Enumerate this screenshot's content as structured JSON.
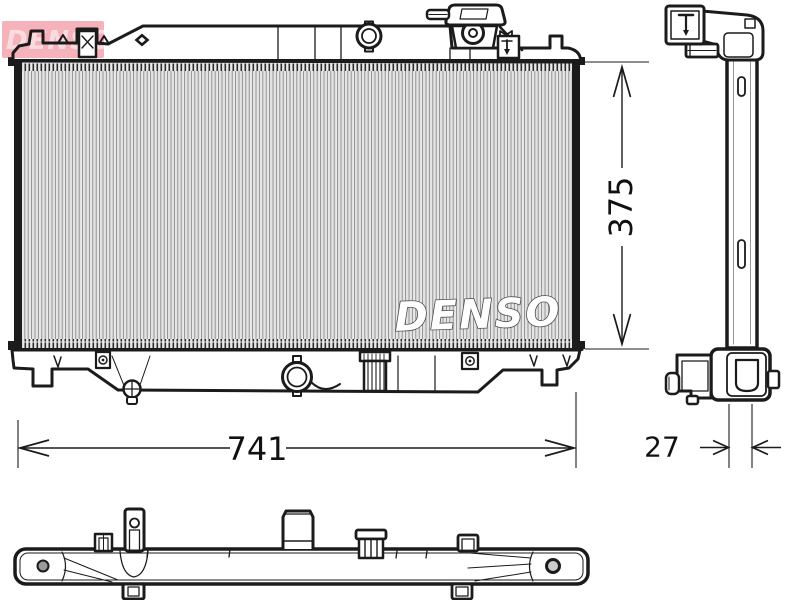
{
  "colors": {
    "background": "#ffffff",
    "line_art": "#1b1b1b",
    "core_hatch": "#909090",
    "watermark_red": "#e8485e",
    "dimension_text": "#111111"
  },
  "watermarks": {
    "corner_logo_text": "DENSO",
    "core_brand_text": "DENSO"
  },
  "dimensions": {
    "width_label": "741",
    "height_label": "375",
    "depth_label": "27"
  }
}
